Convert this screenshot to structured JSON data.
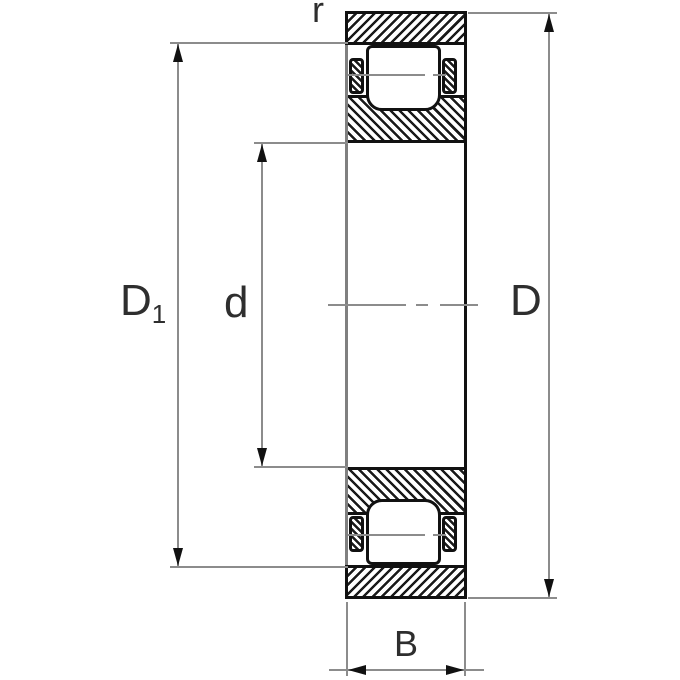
{
  "drawing": {
    "title": "bearing-section-dimension-drawing",
    "labels": {
      "chamfer": "r",
      "d1_base": "D",
      "d1_sub": "1",
      "bore": "d",
      "outside": "D",
      "width": "B"
    },
    "colors": {
      "outline": "#111111",
      "dimension_line": "#8c8c8c",
      "label_text": "#2e2e2e",
      "background": "#ffffff"
    }
  }
}
